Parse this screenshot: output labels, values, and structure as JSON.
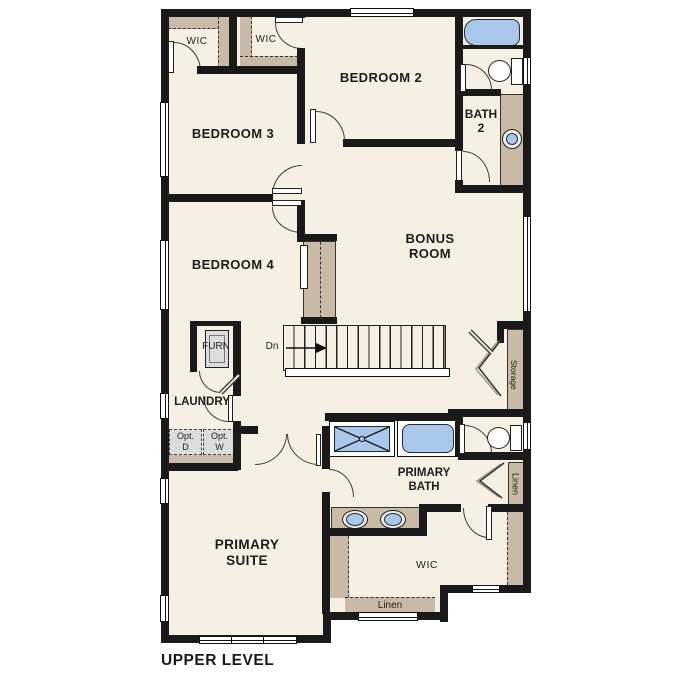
{
  "title": "UPPER LEVEL",
  "colors": {
    "wall": "#1a1a1a",
    "floor": "#f6efe3",
    "closet_tan": "#c8baa6",
    "fixture_blue": "#a9c8e9",
    "appliance_gray": "#dcdcdc",
    "background": "#ffffff"
  },
  "rooms": {
    "wic_bed3": {
      "label": "WIC"
    },
    "wic_bed2": {
      "label": "WIC"
    },
    "bedroom2": {
      "label": "BEDROOM 2"
    },
    "bedroom3": {
      "label": "BEDROOM 3"
    },
    "bedroom4": {
      "label": "BEDROOM 4"
    },
    "bath2": {
      "line1": "BATH",
      "line2": "2"
    },
    "bonus_room": {
      "line1": "BONUS",
      "line2": "ROOM"
    },
    "furnace": {
      "label": "FURN"
    },
    "laundry": {
      "label": "LAUNDRY"
    },
    "optional_dryer": {
      "line1": "Opt.",
      "line2": "D"
    },
    "optional_washer": {
      "line1": "Opt.",
      "line2": "W"
    },
    "storage": {
      "label": "Storage"
    },
    "primary_bath": {
      "line1": "PRIMARY",
      "line2": "BATH"
    },
    "linen_bath": {
      "label": "Linen"
    },
    "primary_suite": {
      "line1": "PRIMARY",
      "line2": "SUITE"
    },
    "wic_primary": {
      "label": "WIC"
    },
    "linen_wic": {
      "label": "Linen"
    },
    "stairs": {
      "label": "Dn"
    }
  }
}
